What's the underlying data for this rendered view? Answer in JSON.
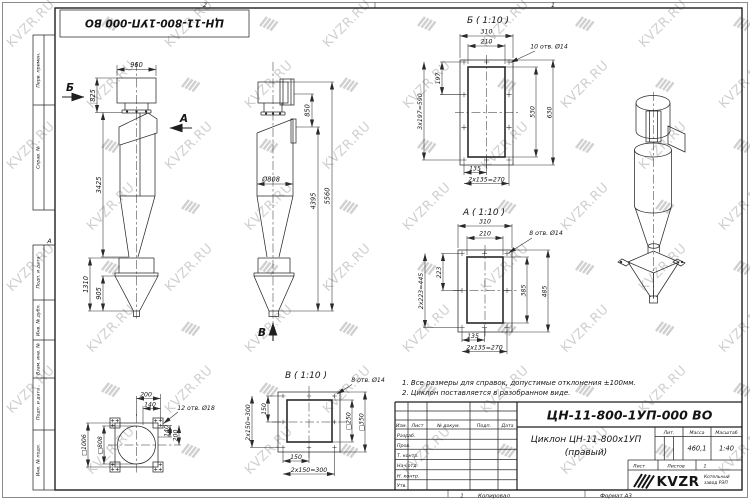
{
  "watermark": {
    "text": "KVZR.RU"
  },
  "frame": {
    "top_stamp": "ЦН-11-800-1УП-000 ВО",
    "margin_labels": [
      "Перв. примен.",
      "Справ. №",
      "Подп. и дата",
      "Инв. № дубл.",
      "Взам. инв. №",
      "Подп. и дата",
      "Инв. № подл."
    ],
    "zone_top_1": "2",
    "zone_top_2": "1",
    "zone_bottom_1": "1",
    "zone_row": "А",
    "copied": "Копировал",
    "format": "Формат А3"
  },
  "views": {
    "front": {
      "label_b": "Б",
      "label_a": "А",
      "dims": {
        "d960": "960",
        "d825": "825",
        "d3425": "3425",
        "d1310": "1310",
        "d905": "905"
      }
    },
    "side": {
      "label_v": "В",
      "dims": {
        "d850": "850",
        "dia": "Ø808",
        "d4395": "4395",
        "d5560": "5560"
      }
    },
    "sec_b": {
      "title": "Б ( 1:10 )",
      "holes": "10 отв. Ø14",
      "dims": {
        "d310": "310",
        "d210": "210",
        "d197": "197",
        "d3x197": "3x197=590",
        "d530": "530",
        "d630": "630",
        "d135": "135",
        "d2x135": "2x135=270"
      }
    },
    "sec_a": {
      "title": "А ( 1:10 )",
      "holes": "8 отв. Ø14",
      "dims": {
        "d310": "310",
        "d210": "210",
        "d223": "223",
        "d2x223": "2x223=445",
        "d385": "385",
        "d485": "485",
        "d135": "135",
        "d2x135": "2x135=270"
      }
    },
    "sec_v": {
      "title": "В ( 1:10 )",
      "holes": "8 отв. Ø14",
      "left": {
        "holes": "12 отв. Ø18",
        "d200t": "200",
        "d140t": "140",
        "d140r": "140",
        "d200r": "200",
        "sq1006": "□1006",
        "sq808": "□808"
      },
      "right": {
        "d150l": "150",
        "d2x150l": "2x150=300",
        "sq250": "□250",
        "sq350": "□350",
        "d150b": "150",
        "d2x150b": "2x150=300"
      }
    }
  },
  "notes": [
    "1. Все размеры для справок, допустимые отклонения ±100мм.",
    "2. Циклон поставляется в разобранном виде."
  ],
  "title_block": {
    "doc_number": "ЦН-11-800-1УП-000 ВО",
    "product": "Циклон ЦН-11-800х1УП",
    "variant": "(правый)",
    "col_headers": [
      "Изм.",
      "Лист",
      "№ докум.",
      "Подп.",
      "Дата"
    ],
    "rows": [
      "Разраб.",
      "Пров.",
      "Т. контр.",
      "Нач.отд.",
      "Н. контр.",
      "Утв."
    ],
    "lit": "Лит.",
    "mass": "Масса",
    "scale": "Масштаб",
    "mass_value": "460,1",
    "scale_value": "1:40",
    "sheet": "Лист",
    "sheets": "Листов",
    "sheets_value": "1",
    "logo": "KVZR",
    "logo_sub1": "Котельный",
    "logo_sub2": "завод РЭП"
  }
}
